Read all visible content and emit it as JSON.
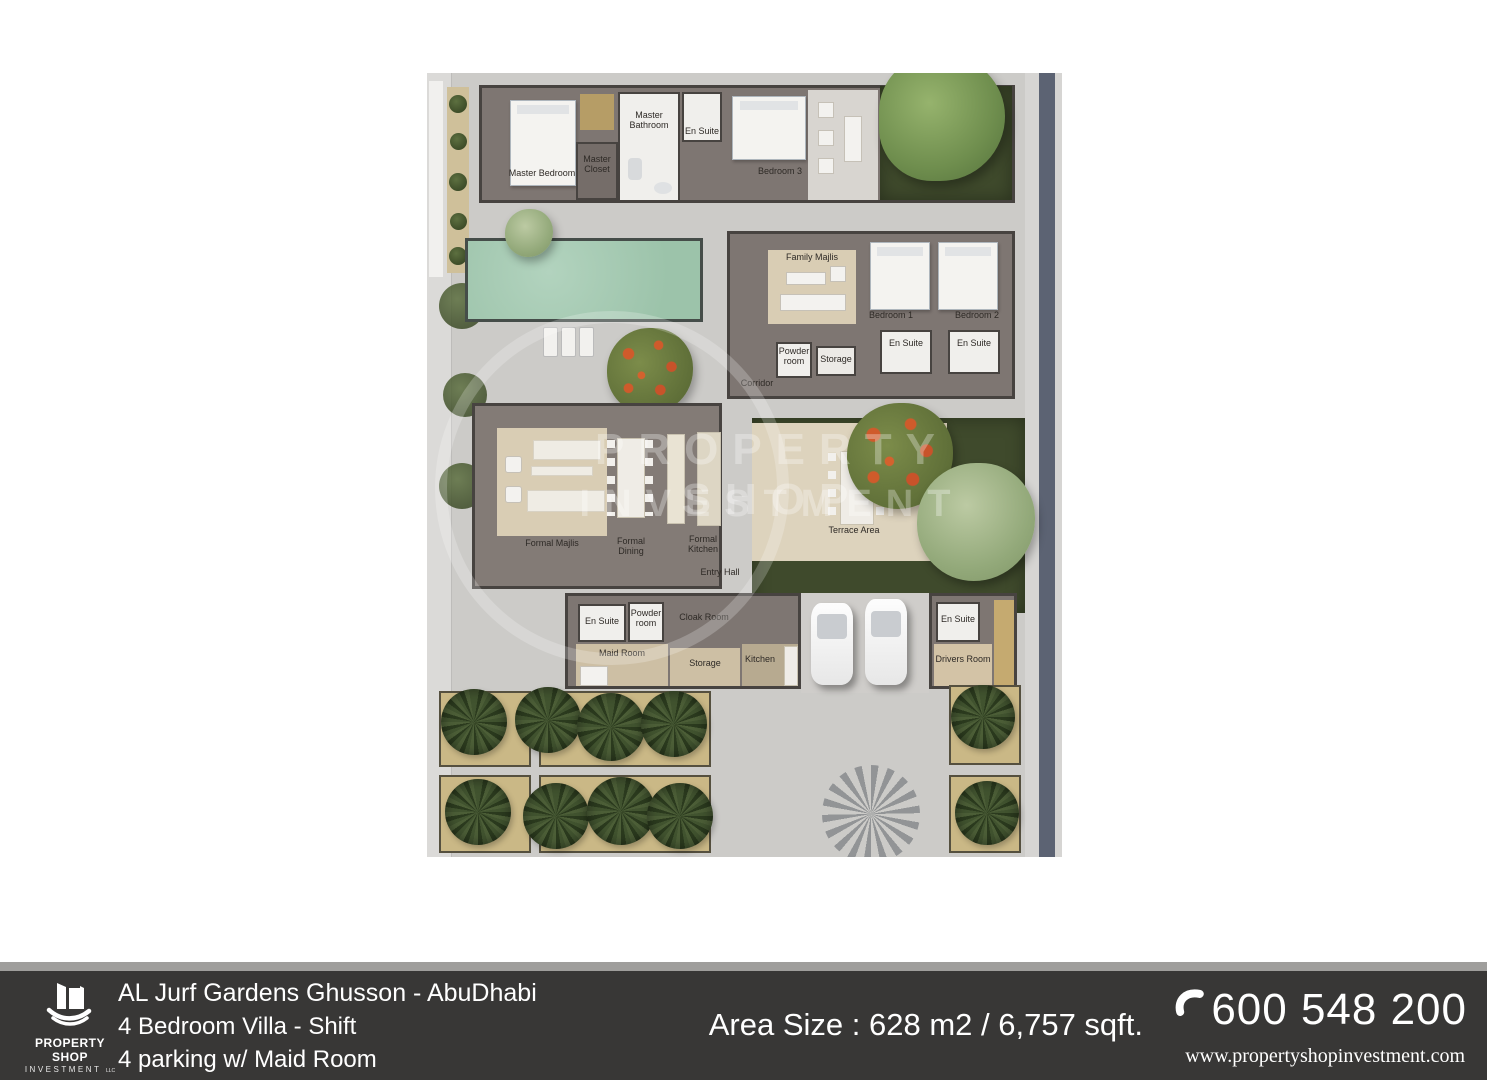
{
  "plan": {
    "watermark": {
      "line1": "PROPERTY SHOP",
      "line2": "INVESTMENT"
    },
    "rooms": {
      "master_bedroom": "Master Bedroom",
      "master_closet": "Master Closet",
      "master_bathroom": "Master Bathroom",
      "en_suite": "En Suite",
      "bedroom_3": "Bedroom 3",
      "family_majlis": "Family Majlis",
      "bedroom_1": "Bedroom 1",
      "bedroom_2": "Bedroom 2",
      "powder_room": "Powder room",
      "storage": "Storage",
      "corridor": "Corridor",
      "formal_majlis": "Formal Majlis",
      "formal_dining": "Formal Dining",
      "formal_kitchen": "Formal Kitchen",
      "entry_hall": "Entry Hall",
      "terrace_area": "Terrace Area",
      "cloak_room": "Cloak Room",
      "maid_room": "Maid Room",
      "kitchen": "Kitchen",
      "drivers_room": "Drivers Room"
    }
  },
  "footer": {
    "logo": {
      "name": "PROPERTY SHOP",
      "sub": "INVESTMENT",
      "suffix": "LLC"
    },
    "project": "AL Jurf Gardens Ghusson - AbuDhabi",
    "line2": "4 Bedroom Villa - Shift",
    "line3": "4 parking w/ Maid Room",
    "area": "Area Size : 628 m2 / 6,757 sqft.",
    "phone": "600 548 200",
    "website": "www.propertyshopinvestment.com"
  },
  "colors": {
    "footer_bar": "#383736",
    "footer_strip": "#9f9e9c",
    "pool": "#a3c8b1",
    "accent": "#ffffff"
  }
}
